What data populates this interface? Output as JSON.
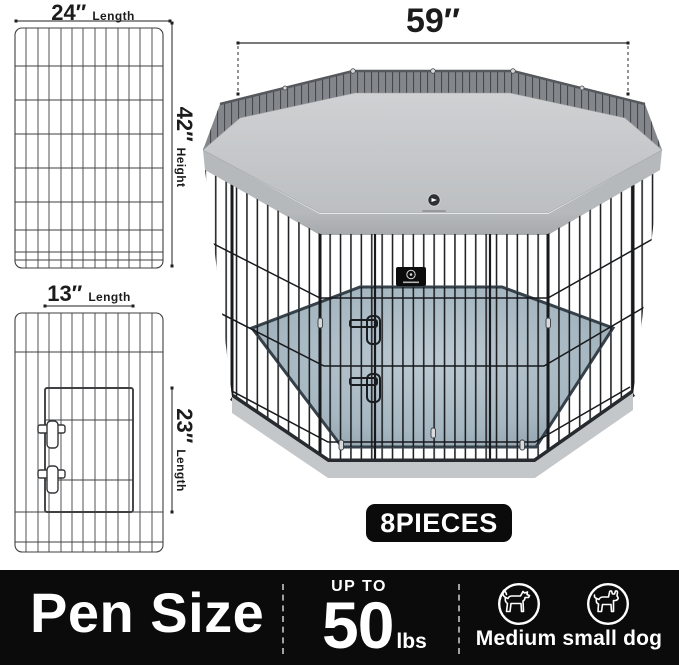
{
  "diagrams": {
    "panel_a": {
      "dim": "24″",
      "dim_label": "Length",
      "side_dim": "42″",
      "side_label": "Height"
    },
    "panel_b": {
      "dim": "13″",
      "dim_label": "Length",
      "side_dim": "23″",
      "side_label": "Length"
    }
  },
  "pen": {
    "width_dim": "59″",
    "pieces_badge": "8PIECES"
  },
  "bottom_bar": {
    "title": "Pen Size",
    "weight_prefix": "UP TO",
    "weight_value": "50",
    "weight_unit": "lbs",
    "dog_label": "Medium small dog"
  },
  "icons": {
    "medium_dog": "medium-dog-icon",
    "small_dog": "small-dog-icon",
    "brand_logo": "brand-logo",
    "brand_badge": "brand-badge"
  },
  "colors": {
    "bar_bg": "#0b0b0c",
    "badge_bg": "#0b0b0c",
    "white": "#ffffff",
    "text_dark": "#1c1c1c",
    "cover_gray": "#c6c8ca",
    "mesh_gray": "#83868a",
    "floor_blue_gray": "#aabbc5",
    "rim_gray": "#c4c7c9",
    "wire_black": "#17191c"
  }
}
